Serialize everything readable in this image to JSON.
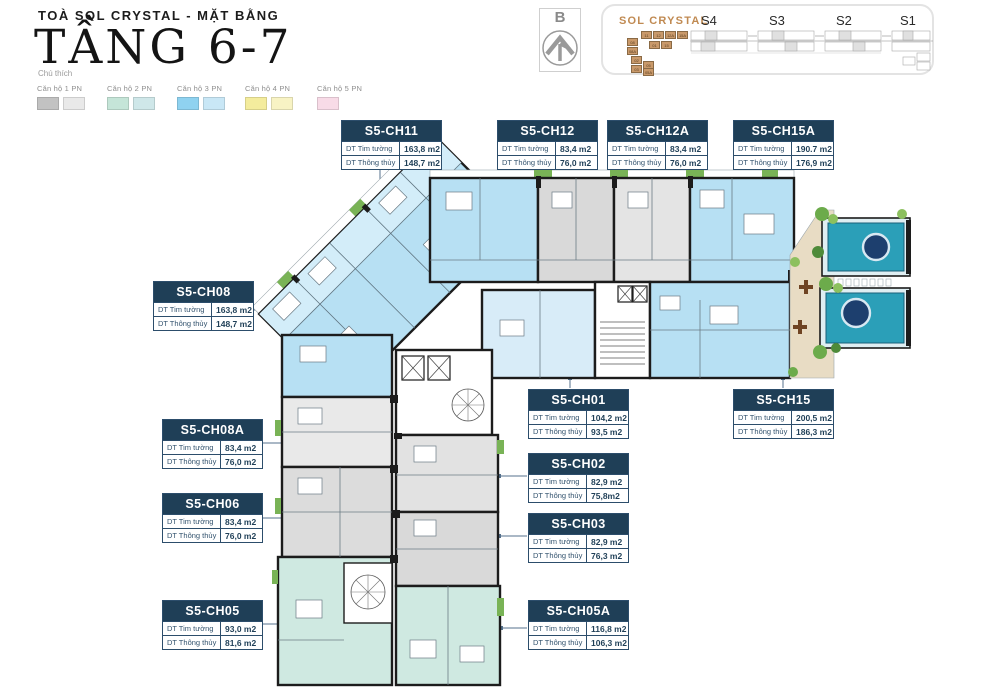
{
  "header": {
    "project_line": "TOÀ SOL CRYSTAL - MẶT BẰNG",
    "floor_title": "TẦNG 6-7"
  },
  "legend": {
    "title": "Chú thích",
    "items": [
      {
        "label": "Căn hộ 1 PN",
        "colors": [
          "#c2c2c2",
          "#e9e9e9"
        ]
      },
      {
        "label": "Căn hộ 2 PN",
        "colors": [
          "#c5e5d8",
          "#cfe7e9"
        ]
      },
      {
        "label": "Căn hộ 3 PN",
        "colors": [
          "#8fd2f0",
          "#c9e7f6"
        ]
      },
      {
        "label": "Căn hộ 4 PN",
        "colors": [
          "#f4ec9d",
          "#f8f3c4"
        ]
      },
      {
        "label": "Căn hộ 5 PN",
        "colors": [
          "#f8dbe7"
        ]
      }
    ]
  },
  "compass": {
    "north_label": "B"
  },
  "site_map": {
    "project_name": "SOL CRYSTAL",
    "building_labels": [
      "S4",
      "S3",
      "S2",
      "S1"
    ],
    "highlighted_units": [
      "11",
      "12",
      "12A",
      "15A",
      "01",
      "15",
      "08",
      "08A",
      "02",
      "03",
      "05",
      "05A"
    ]
  },
  "area_row_labels": {
    "tim": "DT Tim tường",
    "thong": "DT Thông thủy"
  },
  "units": [
    {
      "name": "S5-CH11",
      "tim": "163,8 m2",
      "thong": "148,7 m2"
    },
    {
      "name": "S5-CH12",
      "tim": "83,4 m2",
      "thong": "76,0 m2"
    },
    {
      "name": "S5-CH12A",
      "tim": "83,4 m2",
      "thong": "76,0 m2"
    },
    {
      "name": "S5-CH15A",
      "tim": "190.7 m2",
      "thong": "176,9 m2"
    },
    {
      "name": "S5-CH08",
      "tim": "163,8 m2",
      "thong": "148,7 m2"
    },
    {
      "name": "S5-CH08A",
      "tim": "83,4 m2",
      "thong": "76,0 m2"
    },
    {
      "name": "S5-CH06",
      "tim": "83,4 m2",
      "thong": "76,0 m2"
    },
    {
      "name": "S5-CH05",
      "tim": "93,0 m2",
      "thong": "81,6 m2"
    },
    {
      "name": "S5-CH01",
      "tim": "104,2 m2",
      "thong": "93,5 m2"
    },
    {
      "name": "S5-CH15",
      "tim": "200,5 m2",
      "thong": "186,3 m2"
    },
    {
      "name": "S5-CH02",
      "tim": "82,9 m2",
      "thong": "75,8m2"
    },
    {
      "name": "S5-CH03",
      "tim": "82,9 m2",
      "thong": "76,3 m2"
    },
    {
      "name": "S5-CH05A",
      "tim": "116,8 m2",
      "thong": "106,3 m2"
    }
  ],
  "colors": {
    "navy": "#1f3f57",
    "accent_orange": "#c08a52",
    "pool_teal": "#2b9fb8"
  }
}
